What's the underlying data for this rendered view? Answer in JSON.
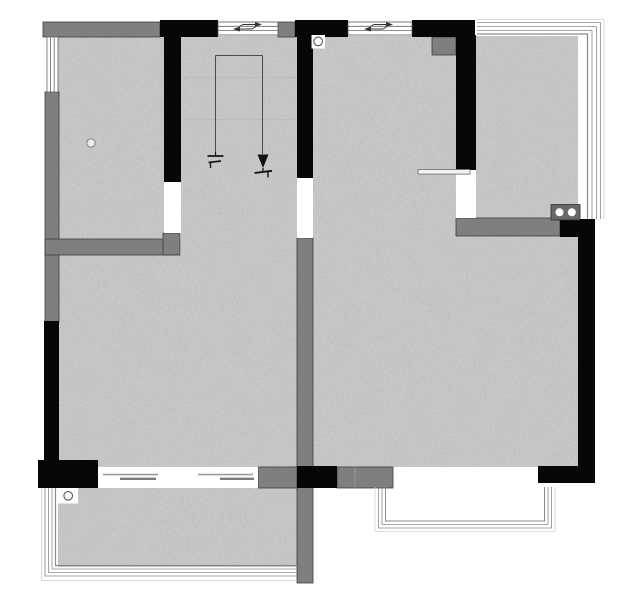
{
  "document": {
    "kind_label": "floor-plan-drawing"
  },
  "colors": {
    "background": "#ffffff",
    "floor_base": "#cdcdcd",
    "grain_tone": "#6f6f6f",
    "wall_primary": "#070707",
    "wall_secondary": "#7f7f7f",
    "wall_secondary_edge": "#3c3c3c",
    "opening_white": "#ffffff",
    "outline": "#8a8a8a",
    "outline_faint": "#d2d2d2",
    "annotation": "#1a1a1a",
    "guide_line": "#4a4a4a",
    "tread_line": "#bdbdbd",
    "panel_line_light": "#9c9c9c",
    "panel_line_dark": "#7b7b7b",
    "appliance_fill": "#686868",
    "appliance_edge": "#2e2e2e",
    "drain_stroke": "#555555",
    "drain_fill": "#fdfdfd"
  },
  "symbols": {
    "stair_direction_marker": "down-arrow-with-start-bar",
    "sliding_window_arrows": "opposing-slide-arrows",
    "cooktop_burner_count": 2,
    "floor_drain": "circle-in-box",
    "bath_drain": "small-circle",
    "sliding_door_panels": 2
  }
}
